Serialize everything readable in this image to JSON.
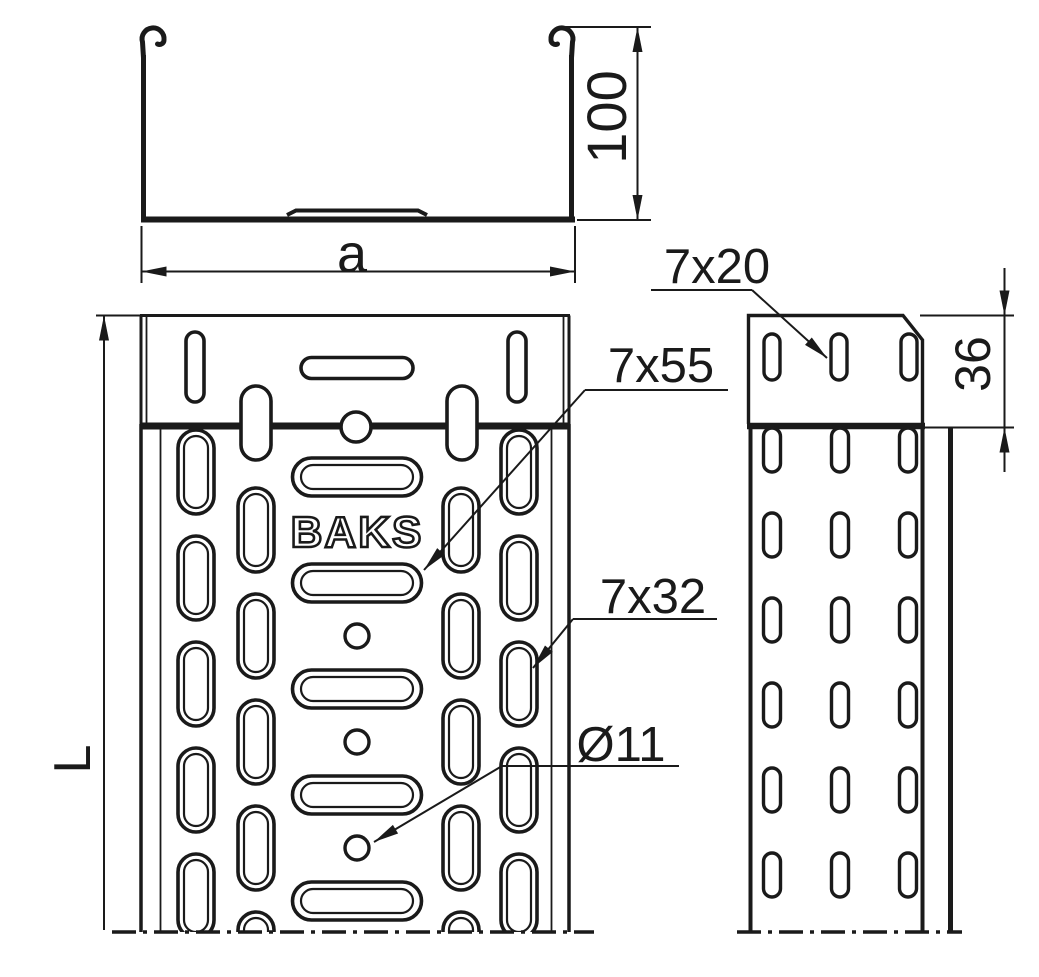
{
  "colors": {
    "line": "#1a1a1a",
    "background": "#ffffff"
  },
  "cross_section_view": {
    "height_dim": "100",
    "width_dim": "a"
  },
  "plan_view": {
    "length_dim": "L",
    "brand_embossing": "BAKS",
    "callouts": {
      "long_slot": "7x55",
      "side_slot": "7x32",
      "hole": "Ø11"
    }
  },
  "side_view": {
    "flange_height_dim": "36",
    "callouts": {
      "connector_slot": "7x20"
    }
  }
}
